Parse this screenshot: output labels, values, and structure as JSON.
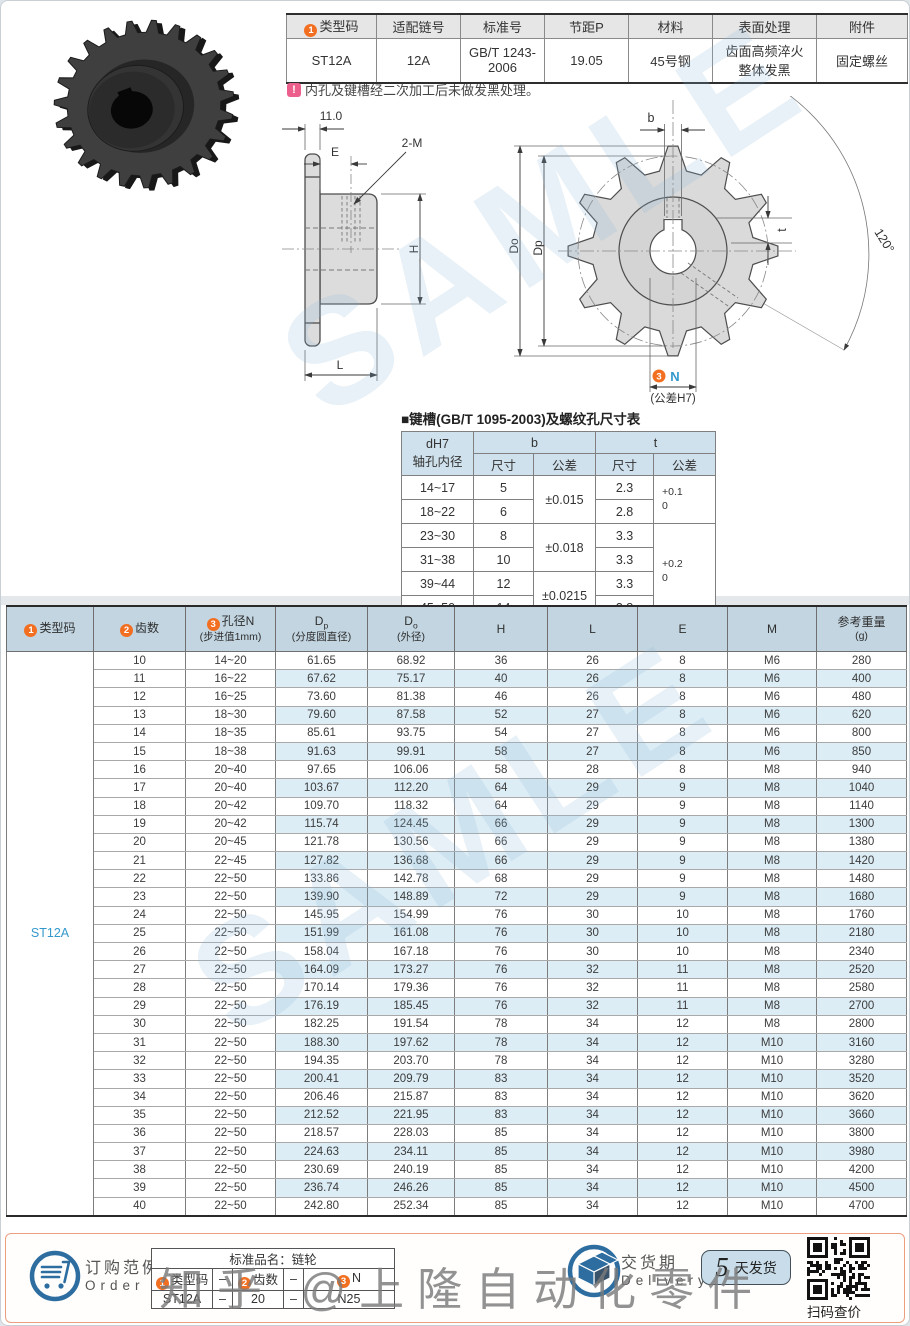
{
  "colors": {
    "accent_orange": "#f26f21",
    "accent_teal": "#3399cc",
    "table_header_bg": "#c2d5e1",
    "stripe_bg": "#dcedf6",
    "footer_border": "#eb9f7f"
  },
  "watermark": {
    "diagonal": "SAMLE",
    "bottom": "知乎 @上隆自动化零件"
  },
  "spec_table": {
    "badge1": "1",
    "headers": {
      "type": "类型码",
      "chain": "适配链号",
      "standard": "标准号",
      "pitch": "节距P",
      "material": "材料",
      "surface": "表面处理",
      "accessory": "附件"
    },
    "values": {
      "type": "ST12A",
      "chain": "12A",
      "standard_l1": "GB/T 1243-",
      "standard_l2": "2006",
      "pitch": "19.05",
      "material": "45号钢",
      "surface_l1": "齿面高频淬火",
      "surface_l2": "整体发黑",
      "accessory": "固定螺丝"
    }
  },
  "note": {
    "icon": "!",
    "text": "内孔及键槽经二次加工后未做发黑处理。"
  },
  "side_view": {
    "dim_width": "11.0",
    "dim_e": "E",
    "thread_label": "2-M",
    "dim_h": "H",
    "dim_l": "L"
  },
  "front_view": {
    "dim_b": "b",
    "dim_angle": "120°",
    "dim_t": "t",
    "dim_do": "Do",
    "dim_dp": "Dp",
    "badge3": "3",
    "dim_n": "N",
    "dim_n_tol": "(公差H7)"
  },
  "keyway_table": {
    "title": "■键槽(GB/T 1095-2003)及螺纹孔尺寸表",
    "h_d": "dH7",
    "h_d2": "轴孔内径",
    "h_b": "b",
    "h_t": "t",
    "h_size": "尺寸",
    "h_tol": "公差",
    "h_size2": "尺寸",
    "h_tol2": "公差",
    "d_ranges": [
      "14~17",
      "18~22",
      "23~30",
      "31~38",
      "39~44",
      "45~50"
    ],
    "b_sizes": [
      "5",
      "6",
      "8",
      "10",
      "12",
      "14"
    ],
    "b_tols": [
      "±0.015",
      "±0.018",
      "±0.0215"
    ],
    "t_sizes": [
      "2.3",
      "2.8",
      "3.3",
      "3.3",
      "3.3",
      "3.8"
    ],
    "t_tols": [
      [
        "+0.1",
        "0"
      ],
      [
        "+0.2",
        "0"
      ]
    ]
  },
  "main_table": {
    "headers": {
      "badge1": "1",
      "col1": "类型码",
      "badge2": "2",
      "col2": "齿数",
      "badge3": "3",
      "col3": "孔径N",
      "col3_sub": "(步进值1mm)",
      "col4_main": "D",
      "col4_sub": "p",
      "col4_cn": "(分度圆直径)",
      "col5_main": "D",
      "col5_sub": "o",
      "col5_cn": "(外径)",
      "col6": "H",
      "col7": "L",
      "col8": "E",
      "col9": "M",
      "col10": "参考重量",
      "col10_sub": "(g)"
    },
    "type_code": "ST12A",
    "rows": [
      [
        "10",
        "14~20",
        "61.65",
        "68.92",
        "36",
        "26",
        "8",
        "M6",
        "280"
      ],
      [
        "11",
        "16~22",
        "67.62",
        "75.17",
        "40",
        "26",
        "8",
        "M6",
        "400"
      ],
      [
        "12",
        "16~25",
        "73.60",
        "81.38",
        "46",
        "26",
        "8",
        "M6",
        "480"
      ],
      [
        "13",
        "18~30",
        "79.60",
        "87.58",
        "52",
        "27",
        "8",
        "M6",
        "620"
      ],
      [
        "14",
        "18~35",
        "85.61",
        "93.75",
        "54",
        "27",
        "8",
        "M6",
        "800"
      ],
      [
        "15",
        "18~38",
        "91.63",
        "99.91",
        "58",
        "27",
        "8",
        "M6",
        "850"
      ],
      [
        "16",
        "20~40",
        "97.65",
        "106.06",
        "58",
        "28",
        "8",
        "M8",
        "940"
      ],
      [
        "17",
        "20~40",
        "103.67",
        "112.20",
        "64",
        "29",
        "9",
        "M8",
        "1040"
      ],
      [
        "18",
        "20~42",
        "109.70",
        "118.32",
        "64",
        "29",
        "9",
        "M8",
        "1140"
      ],
      [
        "19",
        "20~42",
        "115.74",
        "124.45",
        "66",
        "29",
        "9",
        "M8",
        "1300"
      ],
      [
        "20",
        "20~45",
        "121.78",
        "130.56",
        "66",
        "29",
        "9",
        "M8",
        "1380"
      ],
      [
        "21",
        "22~45",
        "127.82",
        "136.68",
        "66",
        "29",
        "9",
        "M8",
        "1420"
      ],
      [
        "22",
        "22~50",
        "133.86",
        "142.78",
        "68",
        "29",
        "9",
        "M8",
        "1480"
      ],
      [
        "23",
        "22~50",
        "139.90",
        "148.89",
        "72",
        "29",
        "9",
        "M8",
        "1680"
      ],
      [
        "24",
        "22~50",
        "145.95",
        "154.99",
        "76",
        "30",
        "10",
        "M8",
        "1760"
      ],
      [
        "25",
        "22~50",
        "151.99",
        "161.08",
        "76",
        "30",
        "10",
        "M8",
        "2180"
      ],
      [
        "26",
        "22~50",
        "158.04",
        "167.18",
        "76",
        "30",
        "10",
        "M8",
        "2340"
      ],
      [
        "27",
        "22~50",
        "164.09",
        "173.27",
        "76",
        "32",
        "11",
        "M8",
        "2520"
      ],
      [
        "28",
        "22~50",
        "170.14",
        "179.36",
        "76",
        "32",
        "11",
        "M8",
        "2580"
      ],
      [
        "29",
        "22~50",
        "176.19",
        "185.45",
        "76",
        "32",
        "11",
        "M8",
        "2700"
      ],
      [
        "30",
        "22~50",
        "182.25",
        "191.54",
        "78",
        "34",
        "12",
        "M8",
        "2800"
      ],
      [
        "31",
        "22~50",
        "188.30",
        "197.62",
        "78",
        "34",
        "12",
        "M10",
        "3160"
      ],
      [
        "32",
        "22~50",
        "194.35",
        "203.70",
        "78",
        "34",
        "12",
        "M10",
        "3280"
      ],
      [
        "33",
        "22~50",
        "200.41",
        "209.79",
        "83",
        "34",
        "12",
        "M10",
        "3520"
      ],
      [
        "34",
        "22~50",
        "206.46",
        "215.87",
        "83",
        "34",
        "12",
        "M10",
        "3620"
      ],
      [
        "35",
        "22~50",
        "212.52",
        "221.95",
        "83",
        "34",
        "12",
        "M10",
        "3660"
      ],
      [
        "36",
        "22~50",
        "218.57",
        "228.03",
        "85",
        "34",
        "12",
        "M10",
        "3800"
      ],
      [
        "37",
        "22~50",
        "224.63",
        "234.11",
        "85",
        "34",
        "12",
        "M10",
        "3980"
      ],
      [
        "38",
        "22~50",
        "230.69",
        "240.19",
        "85",
        "34",
        "12",
        "M10",
        "4200"
      ],
      [
        "39",
        "22~50",
        "236.74",
        "246.26",
        "85",
        "34",
        "12",
        "M10",
        "4500"
      ],
      [
        "40",
        "22~50",
        "242.80",
        "252.34",
        "85",
        "34",
        "12",
        "M10",
        "4700"
      ]
    ]
  },
  "footer": {
    "order_title": "订购范例",
    "order_en": "Order",
    "order_table": {
      "title": "标准品名：链轮",
      "badge1": "1",
      "c1": "类型码",
      "dash1": "–",
      "badge2": "2",
      "c2": "齿数",
      "dash2": "–",
      "badge3": "3",
      "c3": "N",
      "v1": "ST12A",
      "vdash1": "–",
      "v2": "20",
      "vdash2": "–",
      "v3": "N25"
    },
    "delivery_title": "交货期",
    "delivery_en": "Delivery",
    "ship_number": "5",
    "ship_text": "天发货",
    "qr_caption": "扫码查价"
  }
}
